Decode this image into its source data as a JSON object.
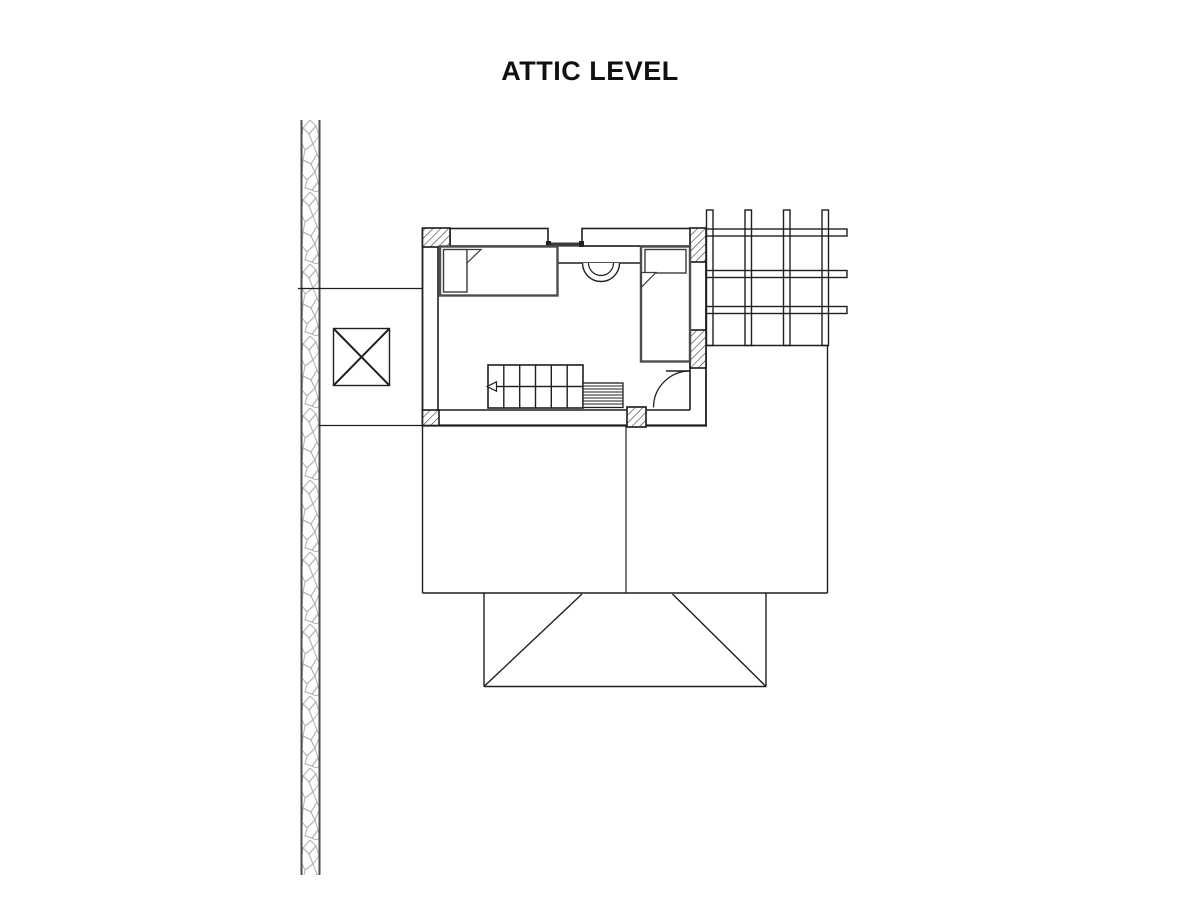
{
  "title": "ATTIC LEVEL",
  "drawing": {
    "type": "architectural-floor-plan",
    "colors": {
      "line": "#1f1f1f",
      "furniture": "#4d4d4d",
      "stone_edge": "#4d4d4d",
      "stone_pattern": "#b0b0b0",
      "background": "#ffffff"
    }
  }
}
